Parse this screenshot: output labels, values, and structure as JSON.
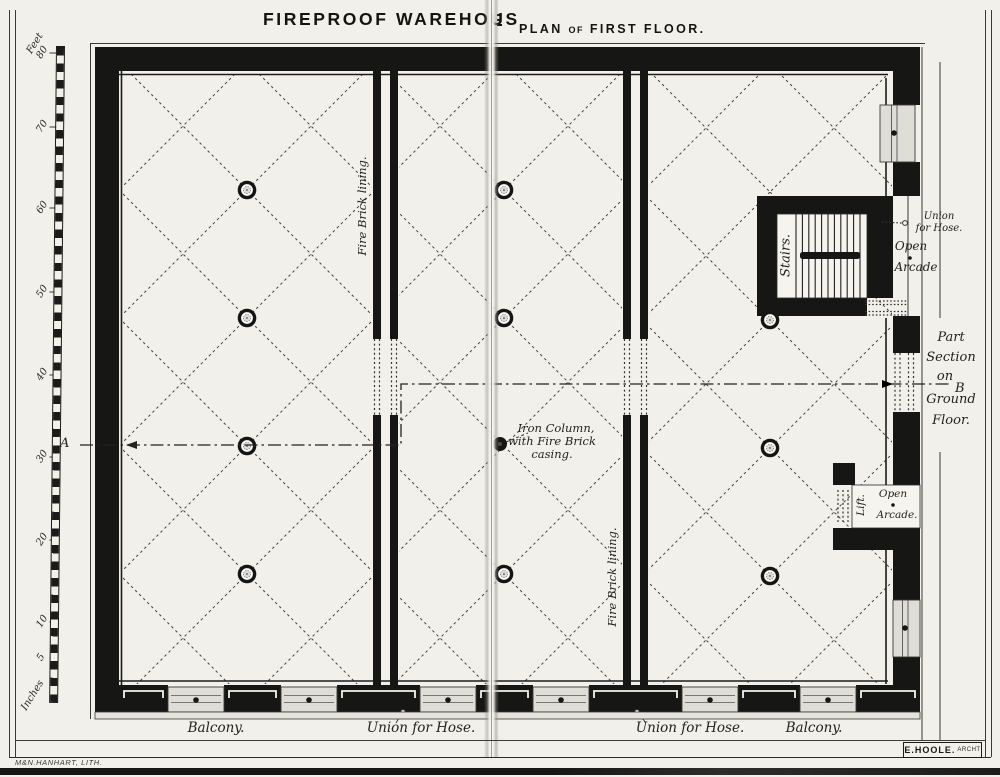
{
  "title": {
    "main": "FIREPROOF WAREHOUS",
    "fold_remnant": "E",
    "sub_parts": [
      "PLAN",
      "OF",
      "FIRST FLOOR."
    ]
  },
  "scale": {
    "unit_top": "Feet",
    "ticks": [
      "80",
      "70",
      "60",
      "50",
      "40",
      "30",
      "20",
      "10",
      "5"
    ],
    "unit_bottom": "Inches"
  },
  "plan": {
    "fire_brick_1": "Fire Brick lining.",
    "fire_brick_2": "Fire Brick lining.",
    "stairs": "Stairs.",
    "lift": "Lift.",
    "iron_column": [
      "Iron Column,",
      "with Fire Brick",
      "casing."
    ],
    "hose_top": [
      "Union",
      "for Hose."
    ],
    "arcade_stairs": [
      "Open",
      "Arcade"
    ],
    "arcade_lift": [
      "Open",
      "Arcade."
    ],
    "part_section": [
      "Part",
      "Section",
      "on",
      "Ground",
      "Floor."
    ],
    "marker_a": "A",
    "marker_b": "B",
    "balcony_l": "Balcony.",
    "hose_l": "Union for Hose.",
    "hose_r": "Union for Hose.",
    "balcony_r": "Balcony."
  },
  "credits": {
    "lith": "M&N.HANHART, LITH.",
    "arch": "E.HOOLE.",
    "arch_suffix": "ARCHT"
  }
}
